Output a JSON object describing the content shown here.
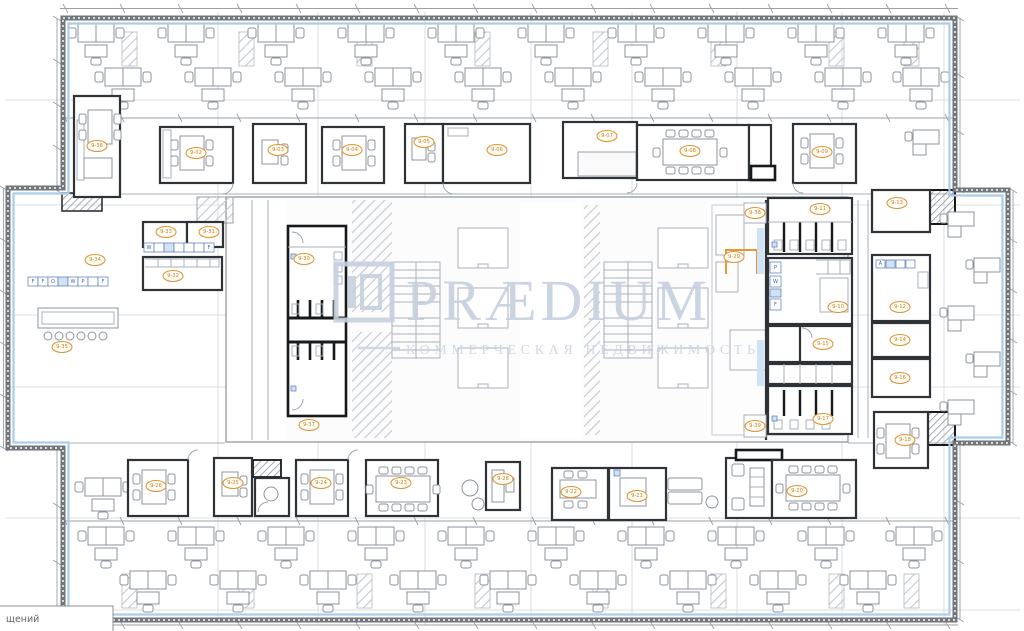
{
  "watermark": {
    "brand": "PRÆDIUM",
    "tagline": "КОММЕРЧЕСКАЯ НЕДВИЖИМОСТЬ"
  },
  "schedule_box": {
    "partial_text": "щений"
  },
  "rooms": {
    "top": [
      "9-36",
      "9-02",
      "9-03",
      "9-04",
      "9-05",
      "9-06",
      "9-07",
      "9-08",
      "9-09"
    ],
    "left": [
      "9-34",
      "9-33",
      "9-31",
      "9-32",
      "9-35"
    ],
    "core": [
      "9-30",
      "9-37",
      "9-29",
      "9-38",
      "9-39"
    ],
    "right": [
      "9-13",
      "9-11",
      "9-10",
      "9-12",
      "9-15",
      "9-14",
      "9-16",
      "9-17",
      "9-18"
    ],
    "bottom": [
      "9-26",
      "9-25",
      "9-24",
      "9-23",
      "9-28",
      "9-22",
      "9-21",
      "9-20"
    ]
  },
  "markers": {
    "wall_cabinets": [
      "F",
      "F",
      "O",
      "W",
      "P",
      "F"
    ],
    "copy_room": [
      "W",
      "F"
    ],
    "pantry": [
      "P",
      "W",
      "F"
    ],
    "right_room": [
      "A"
    ]
  },
  "colors": {
    "perimeter_blue": "#a9cdeb",
    "room_label_orange": "#e0953a",
    "marker_blue": "#3c63c8",
    "watermark_blue": "#c6d0df"
  }
}
